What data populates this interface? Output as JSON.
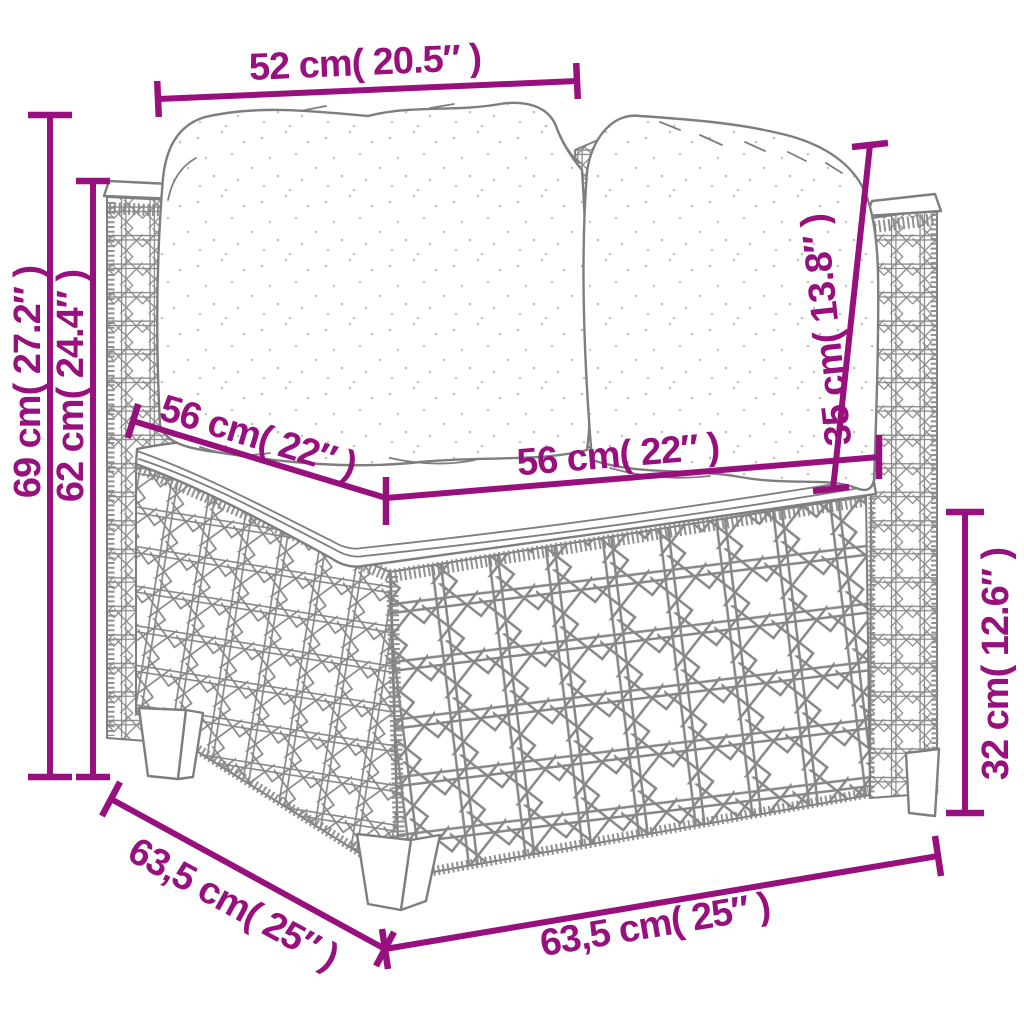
{
  "colors": {
    "dimension_accent": "#97107E",
    "line_art": "#7E7E7E",
    "background": "#FFFFFF"
  },
  "dimensions": {
    "top_width": "52 cm( 20.5″ )",
    "overall_height": "69 cm( 27.2″ )",
    "back_height": "62 cm( 24.4″ )",
    "seat_depth": "56 cm( 22″ )",
    "seat_width": "56 cm( 22″ )",
    "back_cushion_height": "35 cm( 13.8″ )",
    "base_height": "32 cm( 12.6″ )",
    "overall_depth": "63,5 cm( 25″ )",
    "overall_width": "63,5 cm( 25″ )"
  }
}
